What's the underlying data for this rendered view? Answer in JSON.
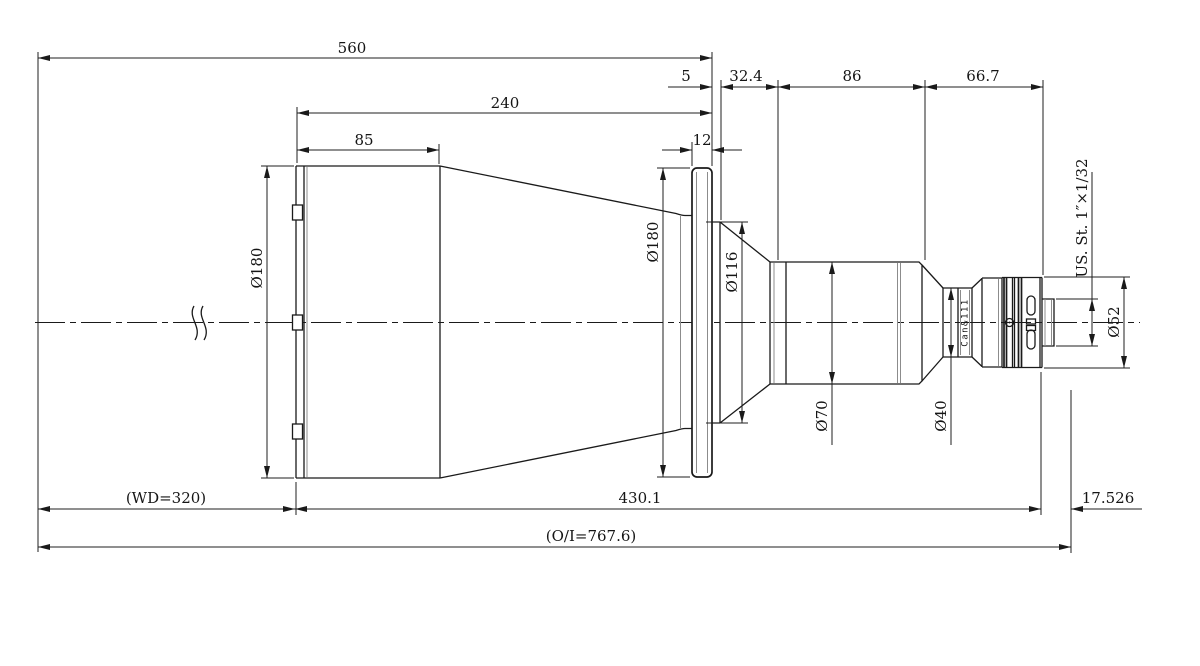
{
  "drawing": {
    "ink_color": "#1a1a1a",
    "background_color": "#ffffff",
    "dims": {
      "d560": "560",
      "d5": "5",
      "d32_4": "32.4",
      "d86": "86",
      "d66_7": "66.7",
      "d240": "240",
      "d85": "85",
      "d12": "12",
      "dia180_front": "Ø180",
      "dia180_flange": "Ø180",
      "dia116": "Ø116",
      "dia70": "Ø70",
      "dia40": "Ø40",
      "dia52": "Ø52",
      "thread": "US. St. 1″×1/32",
      "wd": "(WD=320)",
      "d430_1": "430.1",
      "d17_526": "17.526",
      "oi": "(O/I=767.6)",
      "barrel_marking": "Can&111"
    }
  }
}
